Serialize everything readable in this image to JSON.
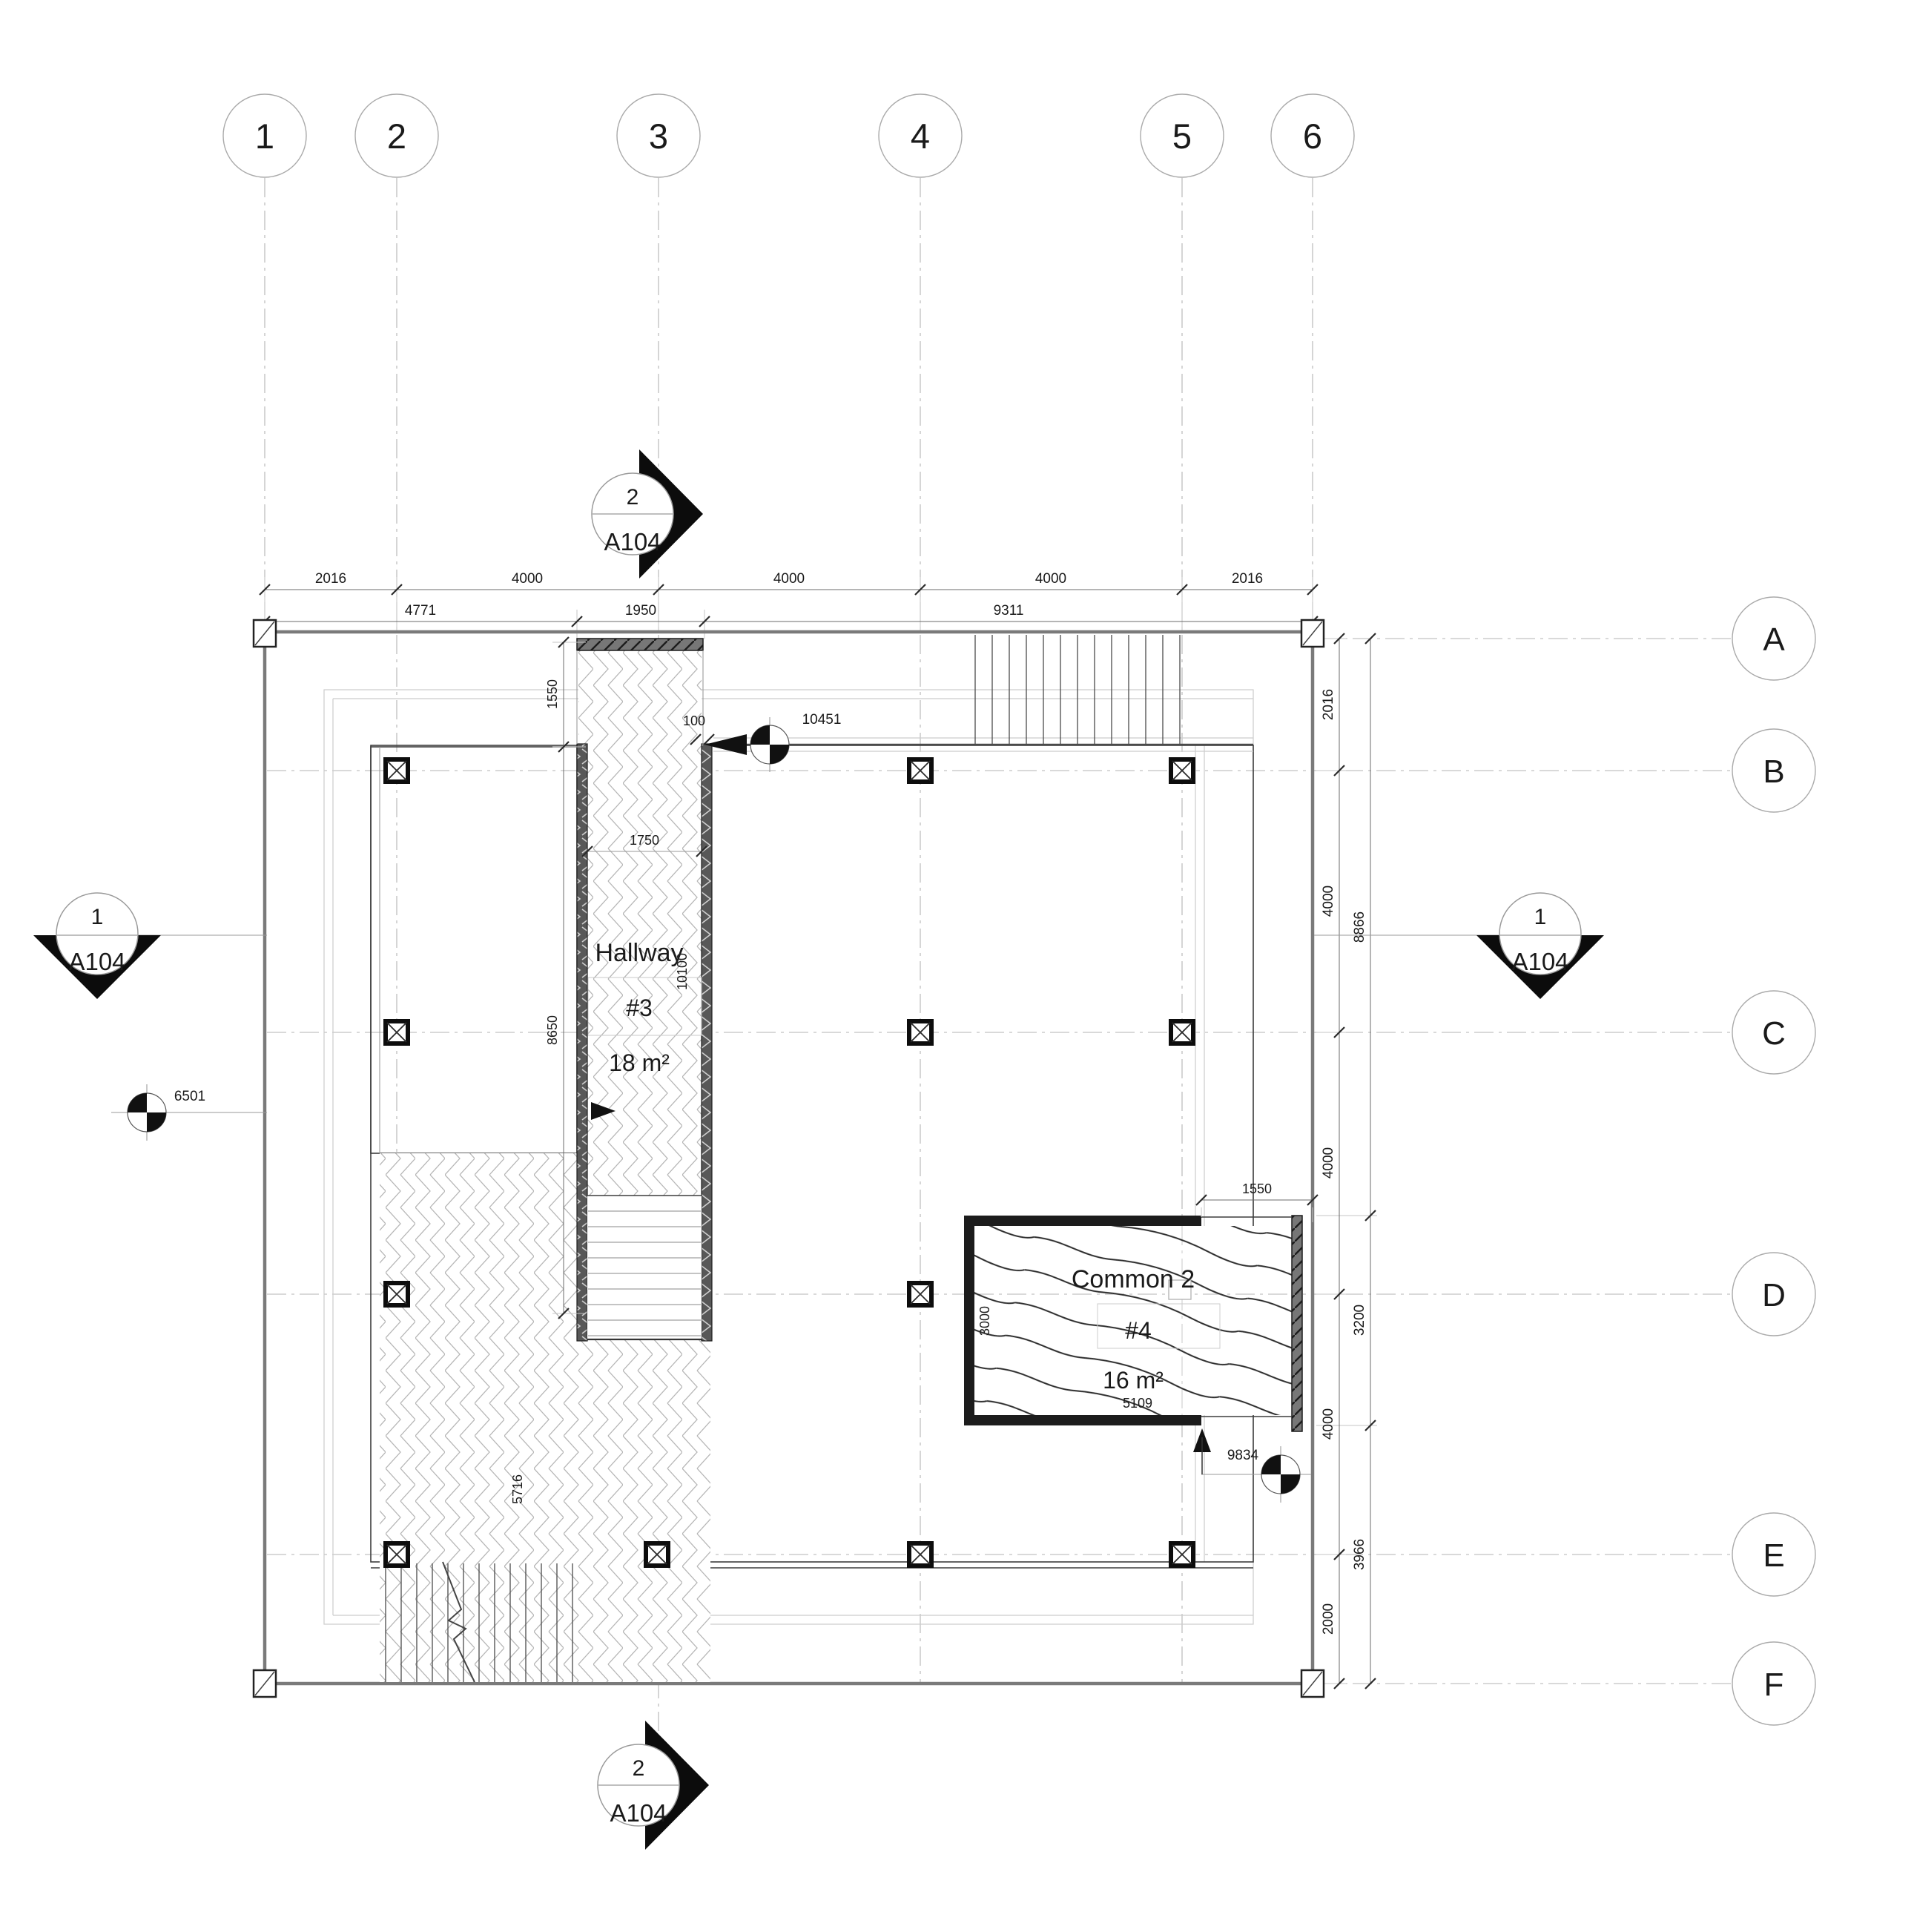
{
  "drawing": {
    "sheet_ref": "A104",
    "grid": {
      "columns": [
        {
          "label": "1"
        },
        {
          "label": "2"
        },
        {
          "label": "3"
        },
        {
          "label": "4"
        },
        {
          "label": "5"
        },
        {
          "label": "6"
        }
      ],
      "rows": [
        {
          "label": "A"
        },
        {
          "label": "B"
        },
        {
          "label": "C"
        },
        {
          "label": "D"
        },
        {
          "label": "E"
        },
        {
          "label": "F"
        }
      ]
    },
    "rooms": {
      "hallway": {
        "name": "Hallway",
        "number": "#3",
        "area": "18 m²"
      },
      "common": {
        "name": "Common 2",
        "number": "#4",
        "area": "16 m²"
      }
    },
    "sections": {
      "top": {
        "number": "2",
        "sheet": "A104"
      },
      "bottom": {
        "number": "2",
        "sheet": "A104"
      },
      "left": {
        "number": "1",
        "sheet": "A104"
      },
      "right": {
        "number": "1",
        "sheet": "A104"
      }
    },
    "dimensions": {
      "top_primary": [
        {
          "value": "2016"
        },
        {
          "value": "4000"
        },
        {
          "value": "4000"
        },
        {
          "value": "4000"
        },
        {
          "value": "2016"
        }
      ],
      "top_secondary": [
        {
          "value": "4771"
        },
        {
          "value": "1950"
        },
        {
          "value": "9311"
        }
      ],
      "right_primary": [
        {
          "value": "2016"
        },
        {
          "value": "4000"
        },
        {
          "value": "4000"
        },
        {
          "value": "4000"
        },
        {
          "value": "2000"
        }
      ],
      "right_secondary": [
        {
          "value": "8866"
        },
        {
          "value": "3200"
        },
        {
          "value": "3966"
        }
      ],
      "annotations": {
        "hallway_north_offset": "1550",
        "hallway_west_span": "8650",
        "hallway_clear_width": "1750",
        "hallway_length": "10100",
        "wall_offset": "100",
        "north_wall_length": "10451",
        "west_benchmark": "6501",
        "southwest_span": "5716",
        "common_depth": "3000",
        "common_width": "5109",
        "common_opening": "1550",
        "south_benchmark": "9834"
      }
    },
    "colors": {
      "line_dark": "#1a1a1a",
      "slab_edge": "#7a7a7a",
      "wall_fill": "#585858",
      "hatch_gray": "#b6b6b6",
      "wood_line": "#2d2d2d"
    }
  }
}
